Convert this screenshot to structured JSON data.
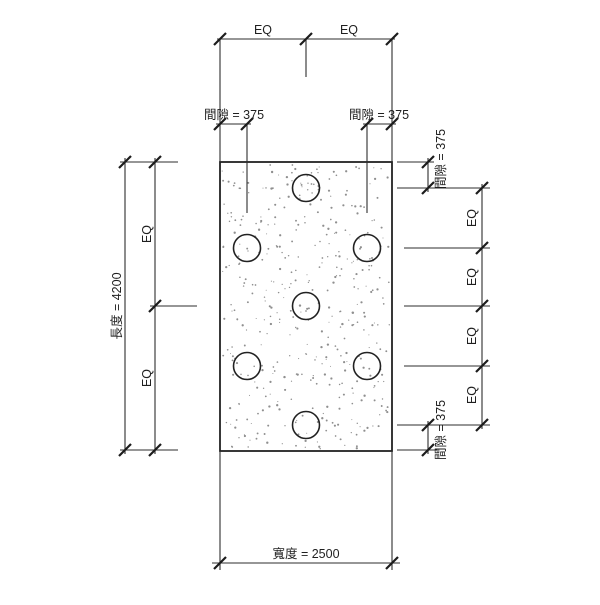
{
  "page": {
    "background": "#ffffff"
  },
  "drawing": {
    "colors": {
      "line": "#2e2e2e",
      "outline": "#222222",
      "tick": "#1c1c1c",
      "stipple": "#8f8f8f",
      "background": "#ffffff"
    },
    "labels": {
      "top_eq_left": "EQ",
      "top_eq_right": "EQ",
      "top_gap_left": "間隙 = 375",
      "top_gap_right": "間隙 = 375",
      "left_length": "長度 = 4200",
      "left_eq_upper": "EQ",
      "left_eq_lower": "EQ",
      "right_gap_top": "間隙 = 375",
      "right_eq_1": "EQ",
      "right_eq_2": "EQ",
      "right_eq_3": "EQ",
      "right_eq_4": "EQ",
      "right_gap_bottom": "間隙 = 375",
      "bottom_width": "寬度 = 2500"
    },
    "values": {
      "length": 4200,
      "width": 2500,
      "edge_gap": 375,
      "hole_count": 7
    }
  }
}
